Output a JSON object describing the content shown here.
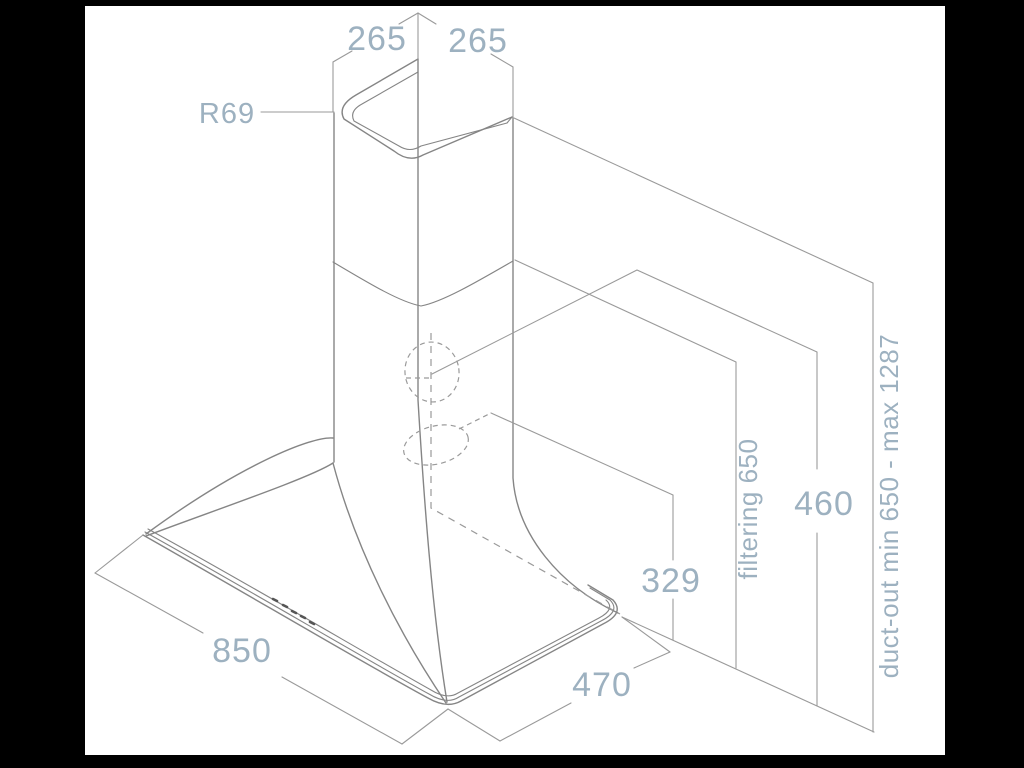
{
  "canvas": {
    "background": "#ffffff",
    "frame": "#000000",
    "line_color": "#858585",
    "dim_line_color": "#9a9a9a",
    "label_color": "#9db1c0",
    "button_color": "#555555"
  },
  "diagram": {
    "type": "isometric technical dimension drawing of a chimney cooker hood",
    "labels": {
      "top_width_left": "265",
      "top_width_right": "265",
      "corner_radius": "R69",
      "filtering_height": "filtering 650",
      "body_height": "460",
      "outlet_height": "329",
      "duct_out_range": "duct-out min 650 - max 1287",
      "base_width": "850",
      "base_depth": "470"
    }
  }
}
